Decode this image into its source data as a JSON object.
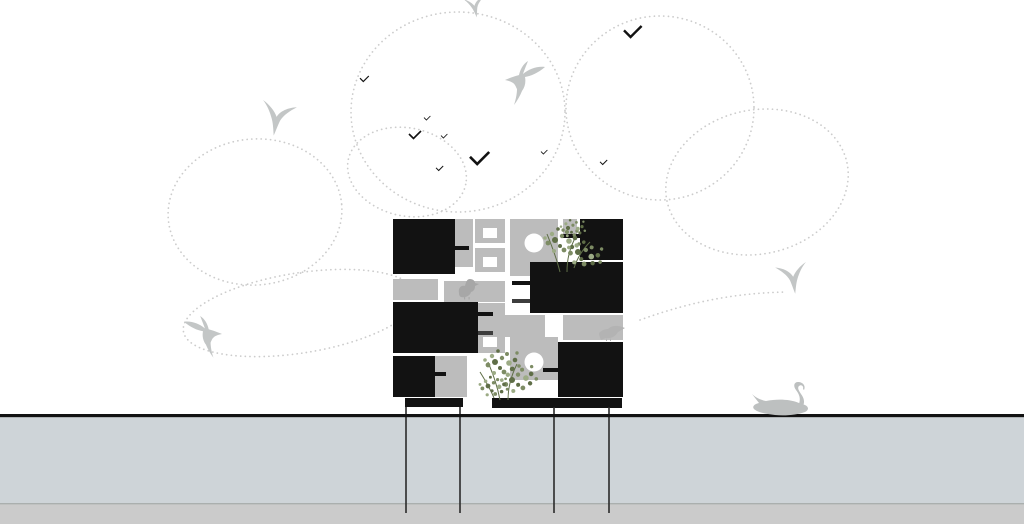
{
  "colors": {
    "paper": "#ffffff",
    "ink": "#121212",
    "block-gray": "#bcbcbc",
    "perch-dark": "#3d3d3d",
    "dot-gray": "#cccccc",
    "bird-gray": "#c3c6c6",
    "duck-gray": "#a7a7a7",
    "dove-gray": "#b3b3b3",
    "swan-gray": "#bdc0c0",
    "leaf-dark": "#5f6e47",
    "leaf-mid": "#7d8c64",
    "leaf-light": "#9cab85",
    "water-band": "#ced4d8",
    "soil-band": "#cbcbcb",
    "band-divider": "#9aa09e",
    "pile-line": "#2a2a2a"
  },
  "scene": {
    "kind": "architectural-section-diagram",
    "sky": {
      "flight_path_loops": 6,
      "flight_path_arcs": 1,
      "hummingbirds": 2,
      "diving_swallows": 3,
      "distant_birds": 9
    },
    "building": {
      "nest_boxes": 6,
      "perches": 8,
      "square_openings": 3,
      "round_openings": 2,
      "planted_terraces": 2,
      "base_plinths": 2
    },
    "ground": {
      "foundation_piles": 4,
      "strata_bands": 2
    },
    "fauna_on_structure": {
      "duck": 1,
      "perched_dove": 1,
      "swan": 1
    }
  }
}
